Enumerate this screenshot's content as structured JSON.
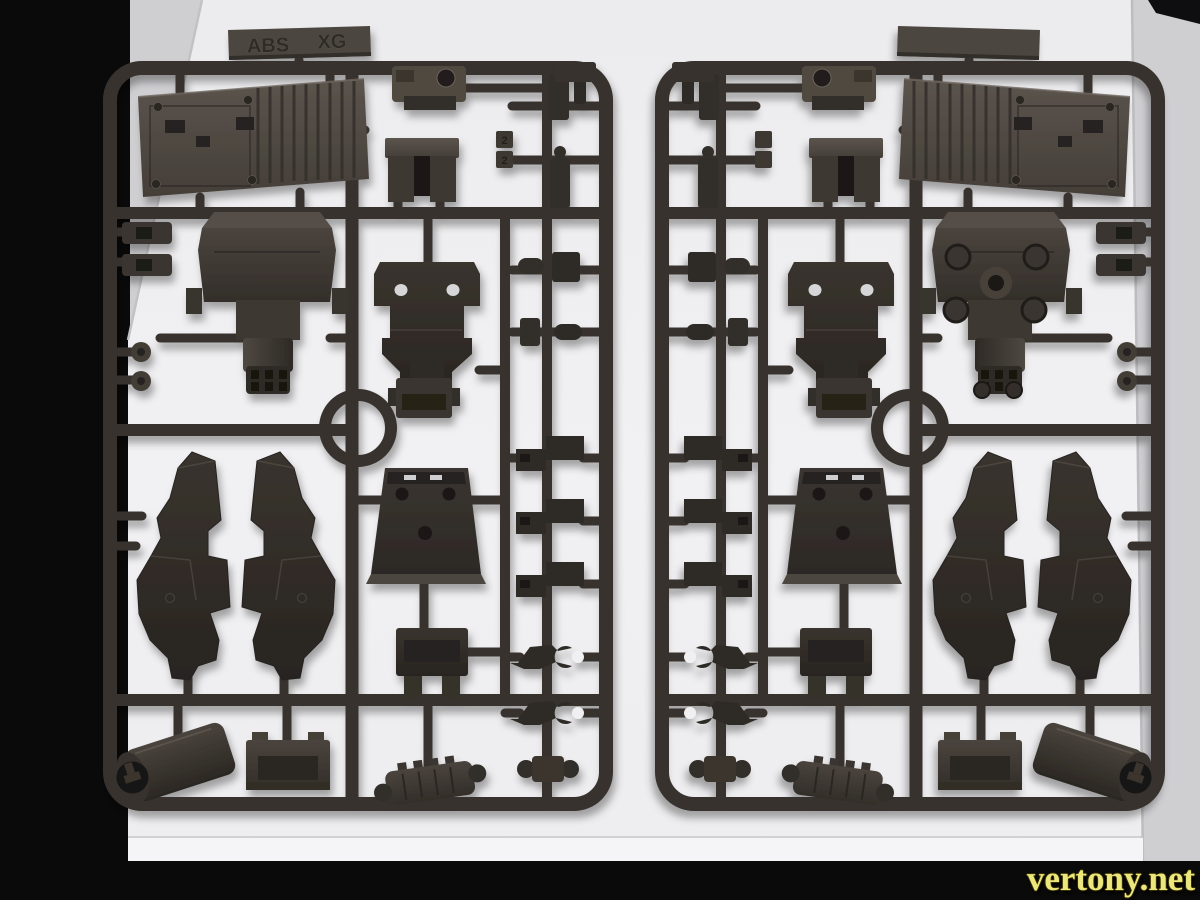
{
  "sprue_marking": {
    "material": "ABS",
    "code": "XG"
  },
  "part_tags": [
    "2",
    "2"
  ],
  "watermark": {
    "text": "vertony.net"
  },
  "colors": {
    "background": "#0a0a0b",
    "backdrop": "#cfcfd2",
    "board": "#f0f0f2",
    "board_edge": "#f5f5f7",
    "sprue": "#38322d",
    "part_dark": "#322d29",
    "part_mid": "#453f39",
    "part_light": "#564f48",
    "hole_dark": "#1b1816",
    "slot_light": "#d6d6d8",
    "emboss": "#2f2b27",
    "watermark": "#ece77c"
  }
}
